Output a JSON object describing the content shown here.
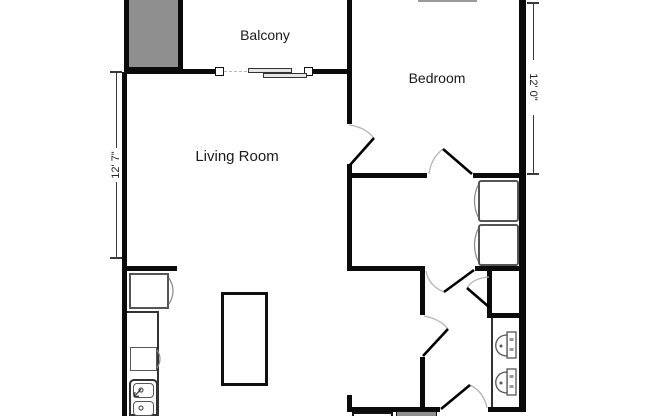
{
  "plan": {
    "title": "apartment-floor-plan",
    "rooms": [
      {
        "id": "balcony",
        "label": "Balcony"
      },
      {
        "id": "bedroom",
        "label": "Bedroom"
      },
      {
        "id": "living-room",
        "label": "Living Room"
      }
    ],
    "dimensions": {
      "left": {
        "value": "12' 7\"",
        "orientation": "vertical",
        "side": "left"
      },
      "right": {
        "value": "12' 0\"",
        "orientation": "vertical",
        "side": "right"
      }
    },
    "fixtures": [
      "sliding-glass-door",
      "refrigerator",
      "kitchen-counter",
      "stove",
      "kitchen-double-sink",
      "kitchen-island",
      "washer-unit",
      "dryer-unit",
      "bathroom-vanity",
      "bathroom-sink-1",
      "bathroom-sink-2"
    ],
    "doors": [
      "bedroom-entry-door",
      "bedroom-closet-door",
      "laundry-room-door",
      "hall-closet-door",
      "bathroom-door",
      "bottom-entry-door"
    ],
    "colors": {
      "wall": "#0b0b0b",
      "shaded-area": "#8f8f8f",
      "door-arc": "#b5b5b5",
      "fixture-outline": "#555555",
      "background": "#ffffff"
    }
  }
}
